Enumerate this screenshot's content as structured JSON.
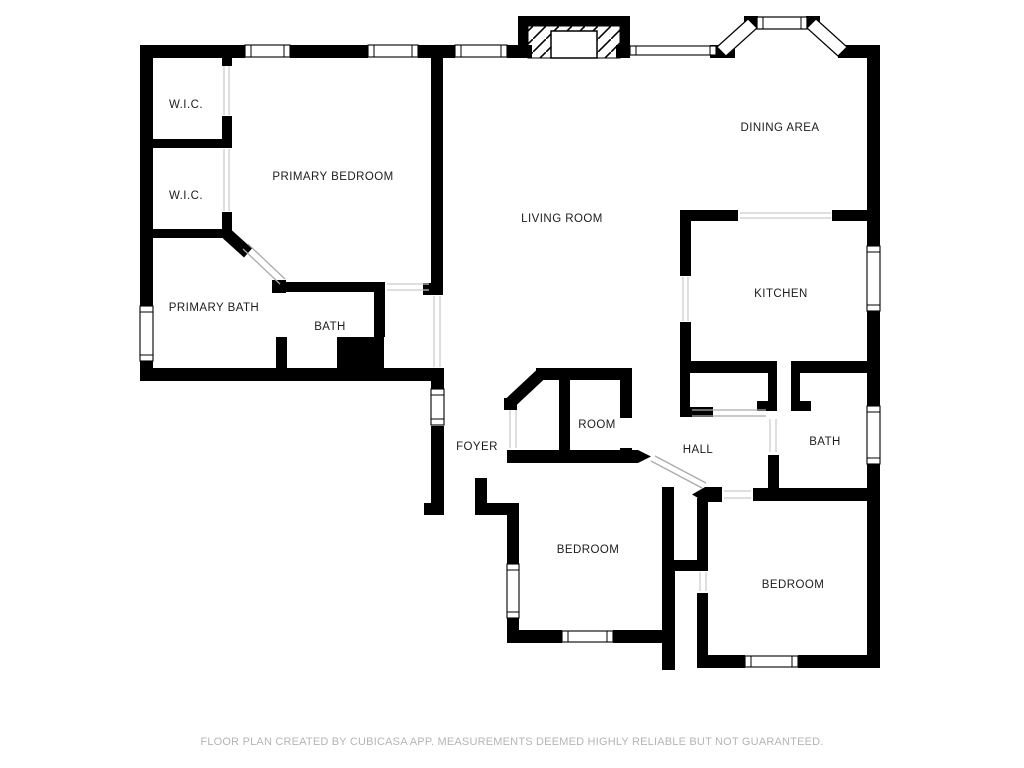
{
  "floor_plan": {
    "rooms": [
      {
        "id": "wic-upper",
        "label": "W.I.C.",
        "x": 186,
        "y": 105
      },
      {
        "id": "wic-lower",
        "label": "W.I.C.",
        "x": 186,
        "y": 196
      },
      {
        "id": "primary-bedroom",
        "label": "PRIMARY BEDROOM",
        "x": 333,
        "y": 177
      },
      {
        "id": "primary-bath",
        "label": "PRIMARY BATH",
        "x": 214,
        "y": 308
      },
      {
        "id": "bath-left",
        "label": "BATH",
        "x": 330,
        "y": 327
      },
      {
        "id": "living-room",
        "label": "LIVING ROOM",
        "x": 562,
        "y": 219
      },
      {
        "id": "dining-area",
        "label": "DINING AREA",
        "x": 780,
        "y": 128
      },
      {
        "id": "kitchen",
        "label": "KITCHEN",
        "x": 781,
        "y": 294
      },
      {
        "id": "foyer",
        "label": "FOYER",
        "x": 477,
        "y": 447
      },
      {
        "id": "room",
        "label": "ROOM",
        "x": 597,
        "y": 425
      },
      {
        "id": "hall",
        "label": "HALL",
        "x": 698,
        "y": 450
      },
      {
        "id": "bath-right",
        "label": "BATH",
        "x": 825,
        "y": 442
      },
      {
        "id": "bedroom-left",
        "label": "BEDROOM",
        "x": 588,
        "y": 550
      },
      {
        "id": "bedroom-right",
        "label": "BEDROOM",
        "x": 793,
        "y": 585
      }
    ],
    "footer": "FLOOR PLAN CREATED BY CUBICASA APP. MEASUREMENTS DEEMED HIGHLY RELIABLE BUT NOT GUARANTEED.",
    "colors": {
      "wall": "#000000",
      "background": "#ffffff",
      "room_label": "#1c1c1c",
      "footer_text": "#b5b5b5",
      "door_swing": "#ababab",
      "opening_line": "#c9c9c9"
    }
  }
}
